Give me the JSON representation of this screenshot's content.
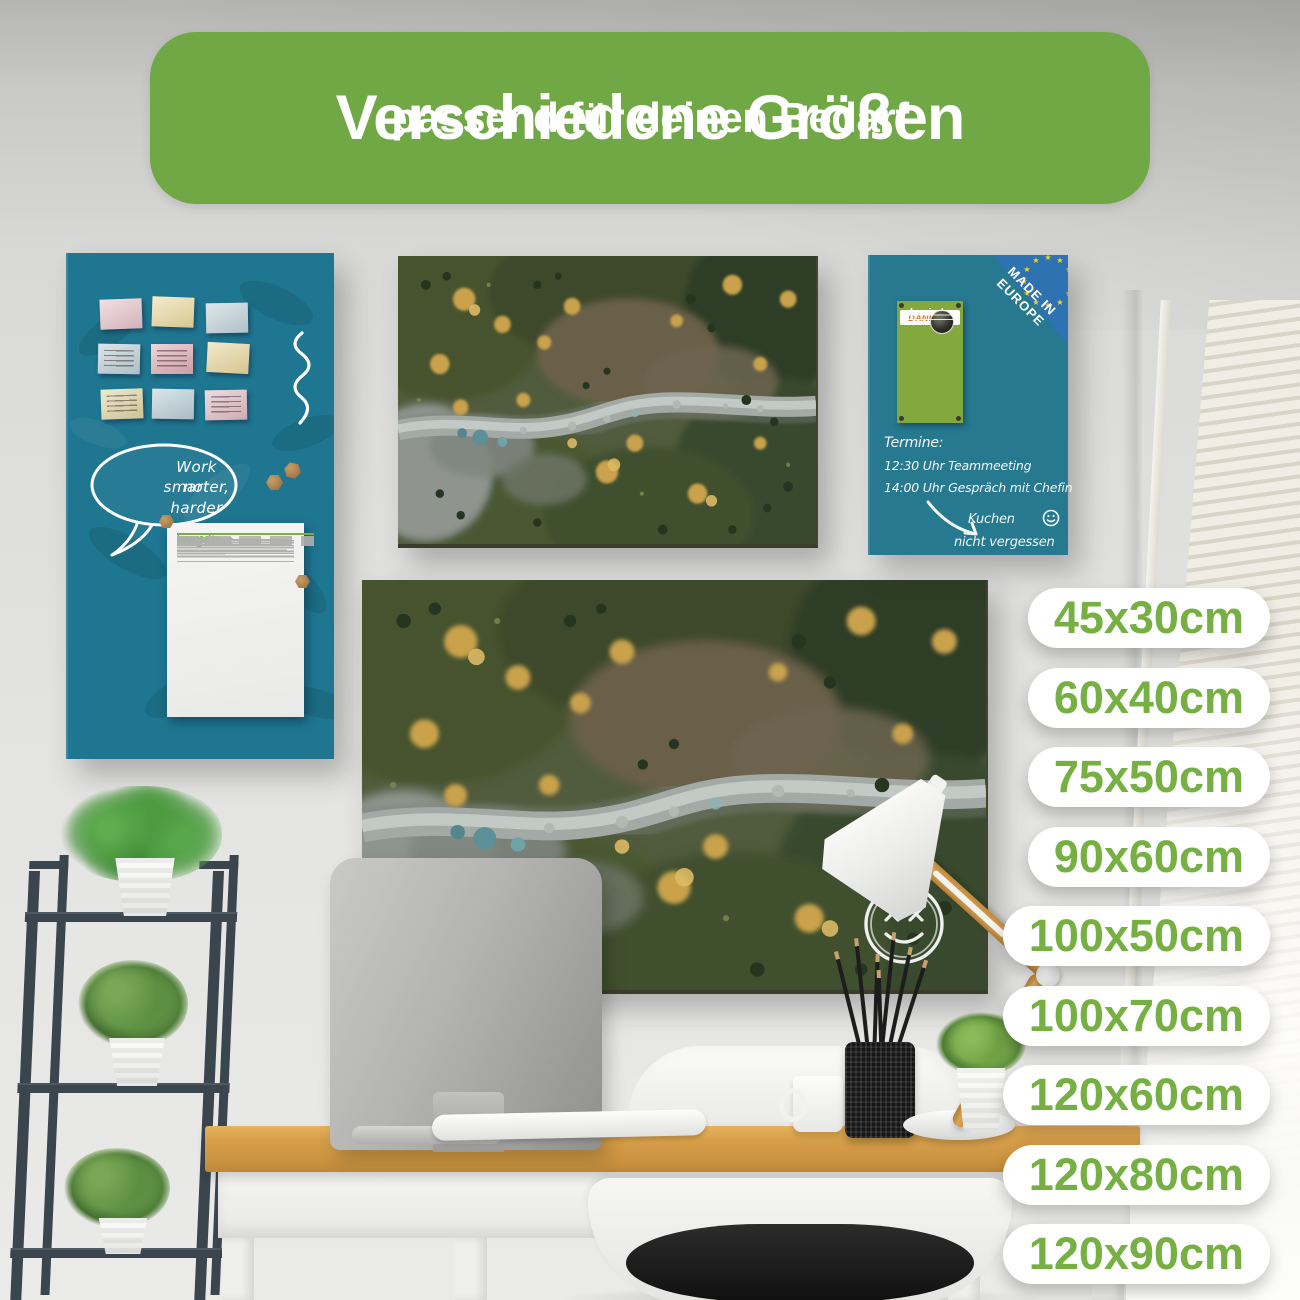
{
  "header": {
    "title": "Verschiedene Größen",
    "subtitle": "passend für deinen Bedarf"
  },
  "sizes": [
    "45x30cm",
    "60x40cm",
    "75x50cm",
    "90x60cm",
    "100x50cm",
    "100x70cm",
    "120x60cm",
    "120x80cm",
    "120x90cm"
  ],
  "left_board": {
    "speech_bubble": {
      "line1": "Work smarter,",
      "line2": "not harder"
    },
    "document": {
      "title": "Angebot",
      "brand": "banjado"
    },
    "sticky_note_colors": [
      "#e3c0c7",
      "#e7d79c",
      "#bdd0d8",
      "#b9cdd5",
      "#dba9b2",
      "#e5d49a",
      "#ddd2a0",
      "#b7cbd3",
      "#dcb9c1"
    ]
  },
  "right_board": {
    "corner": {
      "line1": "MADE IN",
      "line2": "EUROPE"
    },
    "label": {
      "brand": "banjado",
      "thanks": "DANKE!!!"
    },
    "notes": {
      "line1": "Termine:",
      "line2": "12:30 Uhr Teammeeting",
      "line3": "14:00 Uhr Gespräch mit Chefin",
      "line4": "Kuchen",
      "line5": "nicht vergessen"
    }
  },
  "colors": {
    "header_green": "#6fa844",
    "badge_text_green": "#76b043",
    "board_teal": "#1f7690",
    "eu_corner_blue": "#2e72b2",
    "label_green": "#83a93e",
    "danke_orange": "#e0722f",
    "brand_green": "#7cb13f",
    "desk_wood": "#d79f49"
  }
}
